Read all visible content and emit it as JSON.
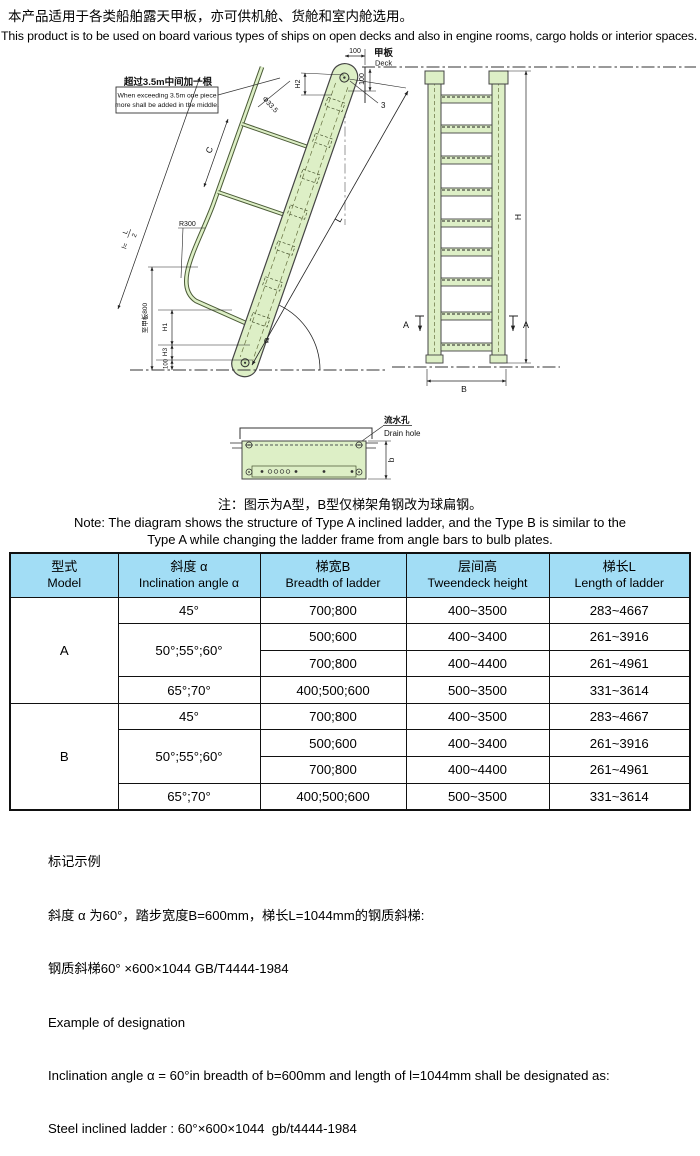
{
  "intro": {
    "zh": "本产品适用于各类船舶露天甲板，亦可供机舱、货舱和室内舱选用。",
    "en": "This product is to be used on board various types of ships on open decks and also in engine rooms, cargo holds or interior spaces."
  },
  "drawing": {
    "callout": {
      "zh": "超过3.5m中间加一根",
      "en1": "When exceeding 3.5m one piece",
      "en2": "more shall be added in the middle."
    },
    "deck": {
      "zh": "甲板",
      "en": "Deck"
    },
    "drain": {
      "zh": "流水孔",
      "en": "Drain hole"
    },
    "dims": {
      "top_100": "100",
      "deck_100": "100",
      "h2": "H2",
      "item_3": "3",
      "pipe_dia": "Φ33.5",
      "c": "C",
      "l": "L",
      "l_half_prefix": "l=",
      "l_half_num": "L",
      "l_half_den": "2",
      "r300": "R300",
      "to_deck_800": "至甲板800",
      "h1": "H1",
      "h3": "H3",
      "bottom_100": "100",
      "alpha": "α",
      "h": "H",
      "b_front": "B",
      "a_left": "A",
      "a_right": "A",
      "b_section": "b"
    }
  },
  "note": {
    "zh": "注：图示为A型，B型仅梯架角钢改为球扁钢。",
    "en1": "Note: The diagram shows the structure of Type A inclined ladder,  and the Type B is similar to the",
    "en2": "Type A while changing the ladder frame from angle bars to bulb plates."
  },
  "table": {
    "headers": [
      {
        "zh": "型式",
        "en": "Model"
      },
      {
        "zh": "斜度 α",
        "en": "Inclination angle α"
      },
      {
        "zh": "梯宽B",
        "en": "Breadth of ladder"
      },
      {
        "zh": "层间高",
        "en": "Tweendeck height"
      },
      {
        "zh": "梯长L",
        "en": "Length of ladder"
      }
    ],
    "groups": [
      {
        "model": "A",
        "rows": [
          {
            "angle": "45°",
            "breadth": "700;800",
            "tweendeck": "400~3500",
            "length": "283~4667"
          },
          {
            "angle": "50°;55°;60°",
            "breadth": "500;600",
            "tweendeck": "400~3400",
            "length": "261~3916"
          },
          {
            "breadth": "700;800",
            "tweendeck": "400~4400",
            "length": "261~4961"
          },
          {
            "angle": "65°;70°",
            "breadth": "400;500;600",
            "tweendeck": "500~3500",
            "length": "331~3614"
          }
        ]
      },
      {
        "model": "B",
        "rows": [
          {
            "angle": "45°",
            "breadth": "700;800",
            "tweendeck": "400~3500",
            "length": "283~4667"
          },
          {
            "angle": "50°;55°;60°",
            "breadth": "500;600",
            "tweendeck": "400~3400",
            "length": "261~3916"
          },
          {
            "breadth": "700;800",
            "tweendeck": "400~4400",
            "length": "261~4961"
          },
          {
            "angle": "65°;70°",
            "breadth": "400;500;600",
            "tweendeck": "500~3500",
            "length": "331~3614"
          }
        ]
      }
    ]
  },
  "example": {
    "title_zh": "标记示例",
    "zh1": "斜度 α 为60°，踏步宽度B=600mm，梯长L=1044mm的钢质斜梯:",
    "zh2": "钢质斜梯60° ×600×1044 GB/T4444-1984",
    "title_en": "Example of designation",
    "en1": "Inclination angle α = 60°in breadth of b=600mm and length of l=1044mm shall be designated as:",
    "en2": "Steel inclined ladder : 60°×600×1044  gb/t4444-1984"
  }
}
